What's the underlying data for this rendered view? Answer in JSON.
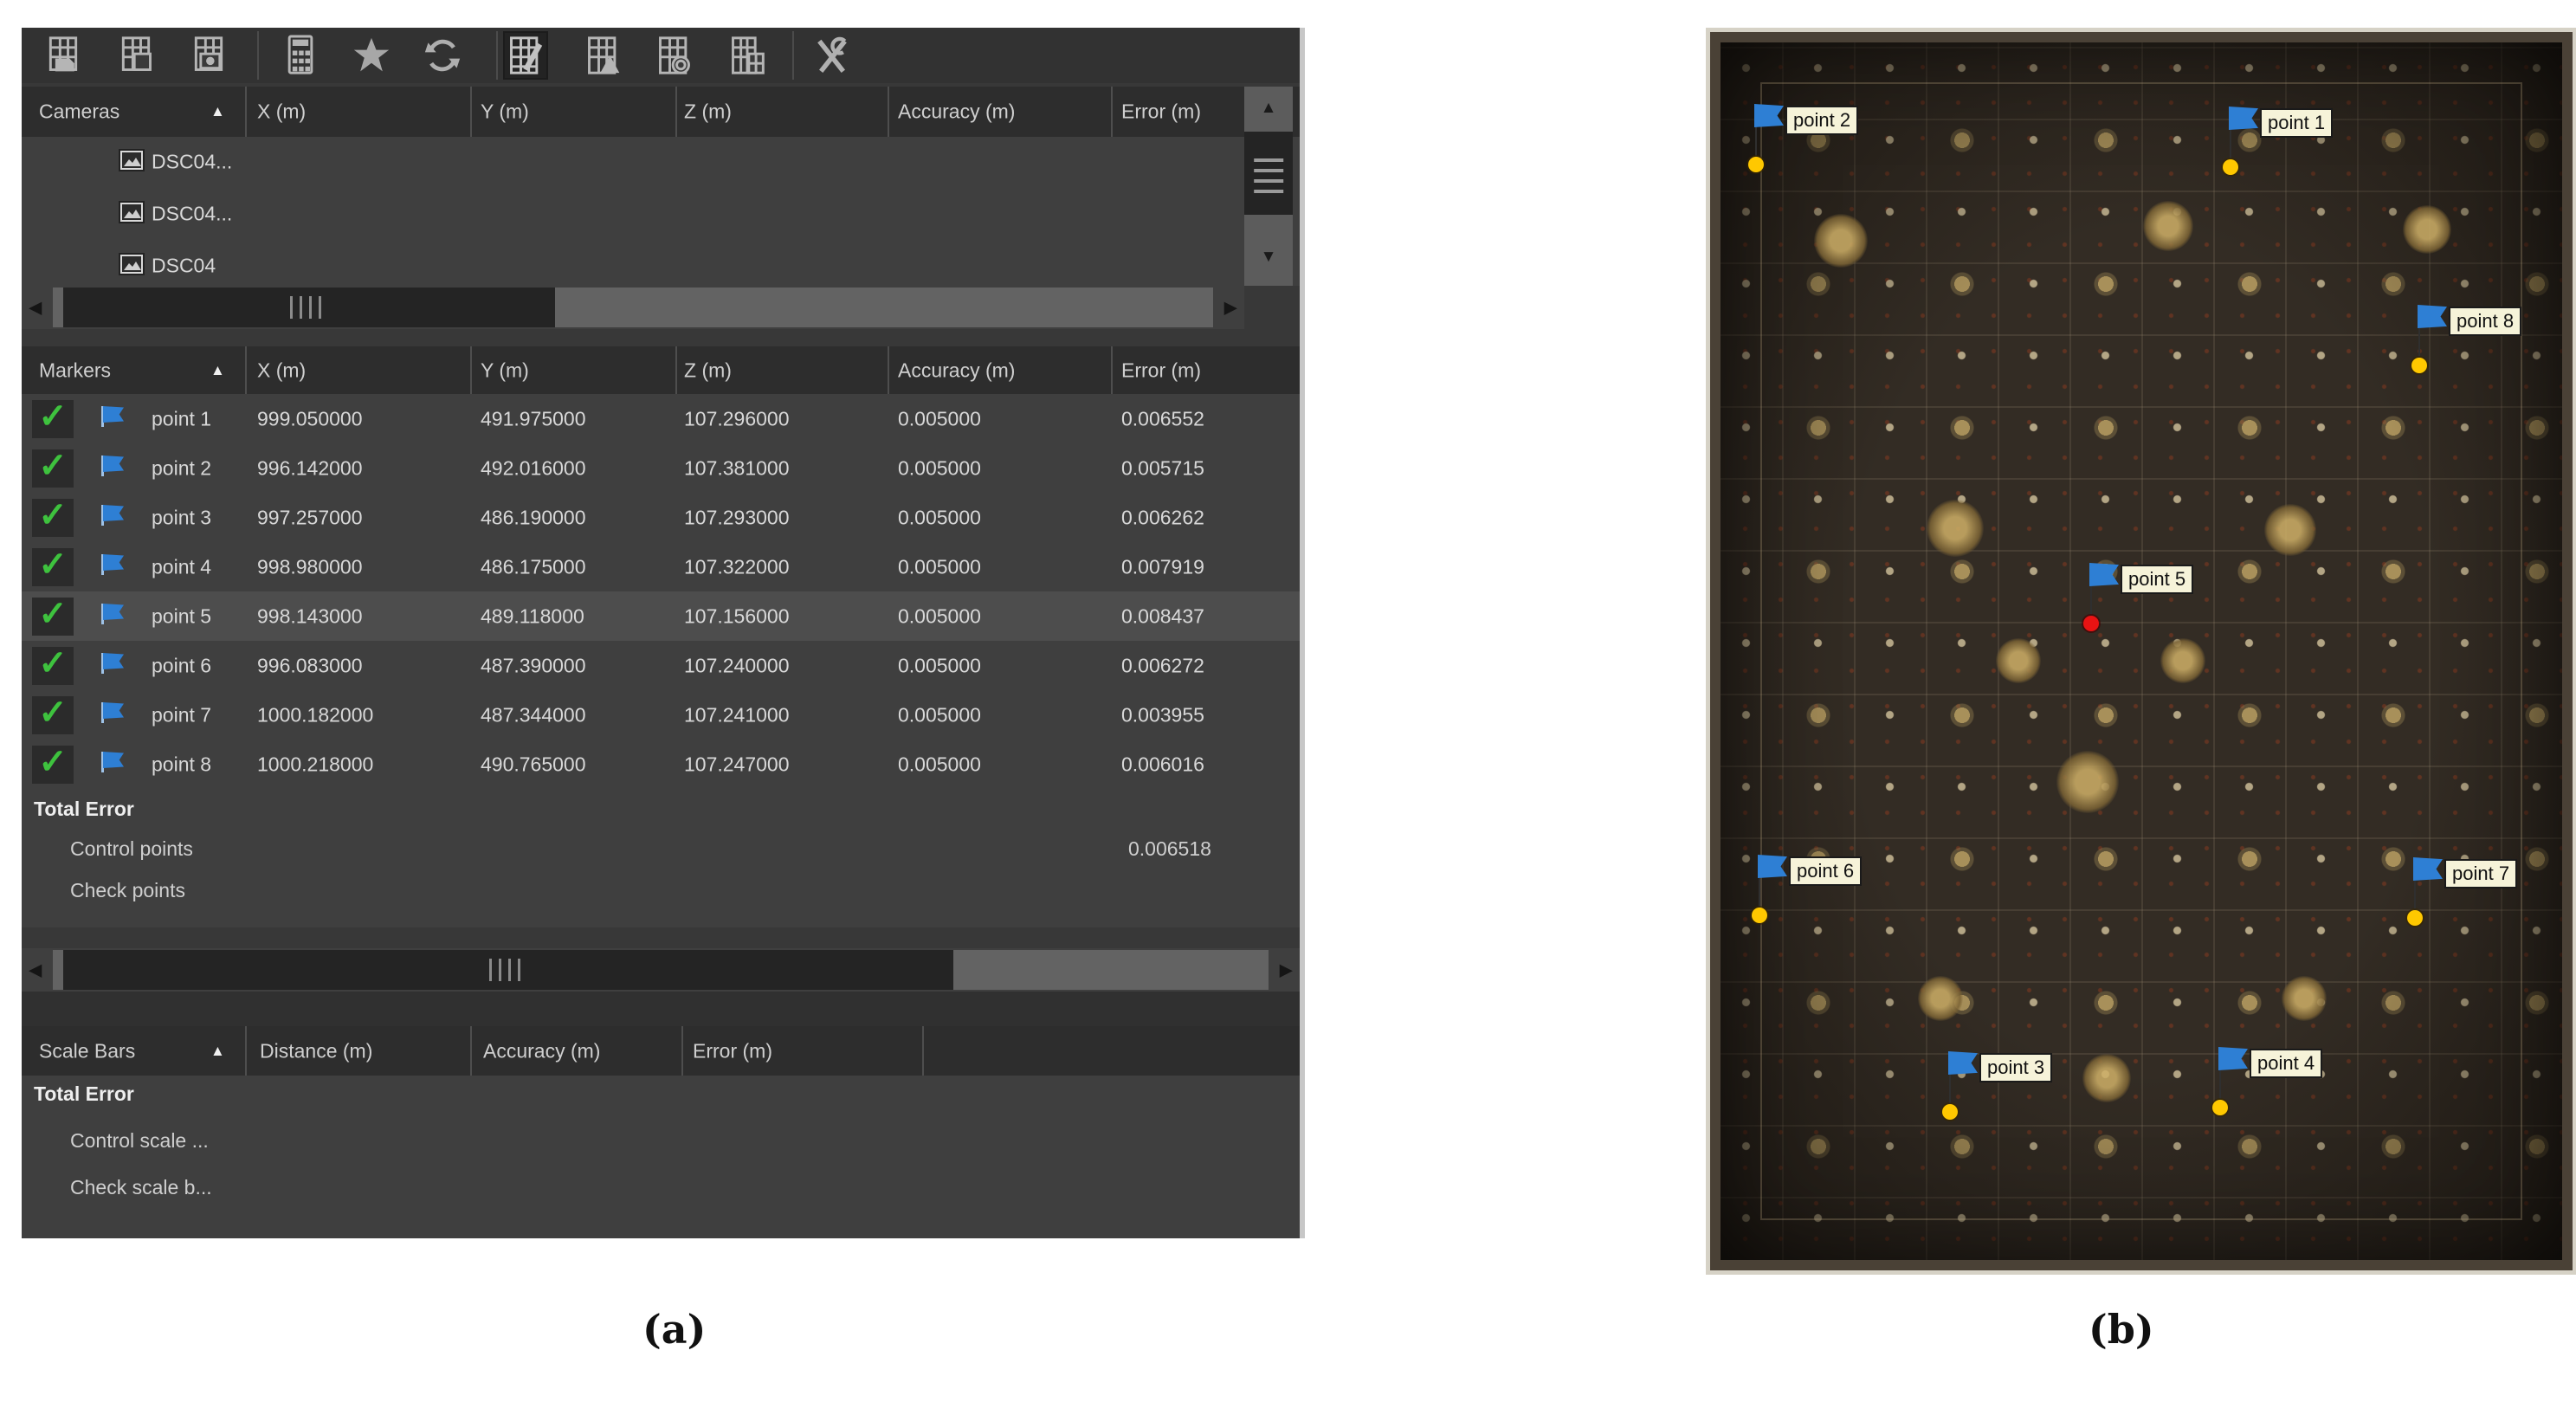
{
  "captions": {
    "a": "(a)",
    "b": "(b)"
  },
  "colors": {
    "panel_bg": "#3f3f3f",
    "header_bg": "#2d2d2d",
    "selection": "#4d4d4d",
    "flag_blue": "#2e7fd4",
    "check_green": "#3ec23e",
    "dot_yellow": "#ffc800",
    "dot_red": "#e81313"
  },
  "toolbar": {
    "icons": [
      "import-reference",
      "export-reference",
      "capture-reference",
      "convert-reference",
      "optimize-cameras",
      "update-transform",
      "view-estimated",
      "view-errors",
      "view-variance",
      "view-rotation-angles",
      "reference-settings"
    ],
    "selected": "view-estimated"
  },
  "cameras": {
    "title": "Cameras",
    "columns": [
      "X (m)",
      "Y (m)",
      "Z (m)",
      "Accuracy (m)",
      "Error (m)"
    ],
    "rows": [
      {
        "name": "DSC04..."
      },
      {
        "name": "DSC04..."
      },
      {
        "name": "DSC04"
      }
    ]
  },
  "markers": {
    "title": "Markers",
    "columns": [
      "X (m)",
      "Y (m)",
      "Z (m)",
      "Accuracy (m)",
      "Error (m)"
    ],
    "rows": [
      {
        "name": "point 1",
        "x": "999.050000",
        "y": "491.975000",
        "z": "107.296000",
        "accuracy": "0.005000",
        "error": "0.006552"
      },
      {
        "name": "point 2",
        "x": "996.142000",
        "y": "492.016000",
        "z": "107.381000",
        "accuracy": "0.005000",
        "error": "0.005715"
      },
      {
        "name": "point 3",
        "x": "997.257000",
        "y": "486.190000",
        "z": "107.293000",
        "accuracy": "0.005000",
        "error": "0.006262"
      },
      {
        "name": "point 4",
        "x": "998.980000",
        "y": "486.175000",
        "z": "107.322000",
        "accuracy": "0.005000",
        "error": "0.007919"
      },
      {
        "name": "point 5",
        "x": "998.143000",
        "y": "489.118000",
        "z": "107.156000",
        "accuracy": "0.005000",
        "error": "0.008437"
      },
      {
        "name": "point 6",
        "x": "996.083000",
        "y": "487.390000",
        "z": "107.240000",
        "accuracy": "0.005000",
        "error": "0.006272"
      },
      {
        "name": "point 7",
        "x": "1000.182000",
        "y": "487.344000",
        "z": "107.241000",
        "accuracy": "0.005000",
        "error": "0.003955"
      },
      {
        "name": "point 8",
        "x": "1000.218000",
        "y": "490.765000",
        "z": "107.247000",
        "accuracy": "0.005000",
        "error": "0.006016"
      }
    ],
    "total_error": {
      "label": "Total Error",
      "control_points_label": "Control points",
      "control_points_value": "0.006518",
      "check_points_label": "Check points"
    }
  },
  "scale_bars": {
    "title": "Scale Bars",
    "columns": [
      "Distance (m)",
      "Accuracy (m)",
      "Error (m)"
    ],
    "total_error_label": "Total Error",
    "control_label": "Control scale ...",
    "check_label": "Check scale b..."
  },
  "photo": {
    "flags": [
      {
        "label": "point 2",
        "dot": "yellow"
      },
      {
        "label": "point 1",
        "dot": "yellow"
      },
      {
        "label": "point 8",
        "dot": "yellow"
      },
      {
        "label": "point 5",
        "dot": "red"
      },
      {
        "label": "point 6",
        "dot": "yellow"
      },
      {
        "label": "point 7",
        "dot": "yellow"
      },
      {
        "label": "point 3",
        "dot": "yellow"
      },
      {
        "label": "point 4",
        "dot": "yellow"
      }
    ]
  }
}
